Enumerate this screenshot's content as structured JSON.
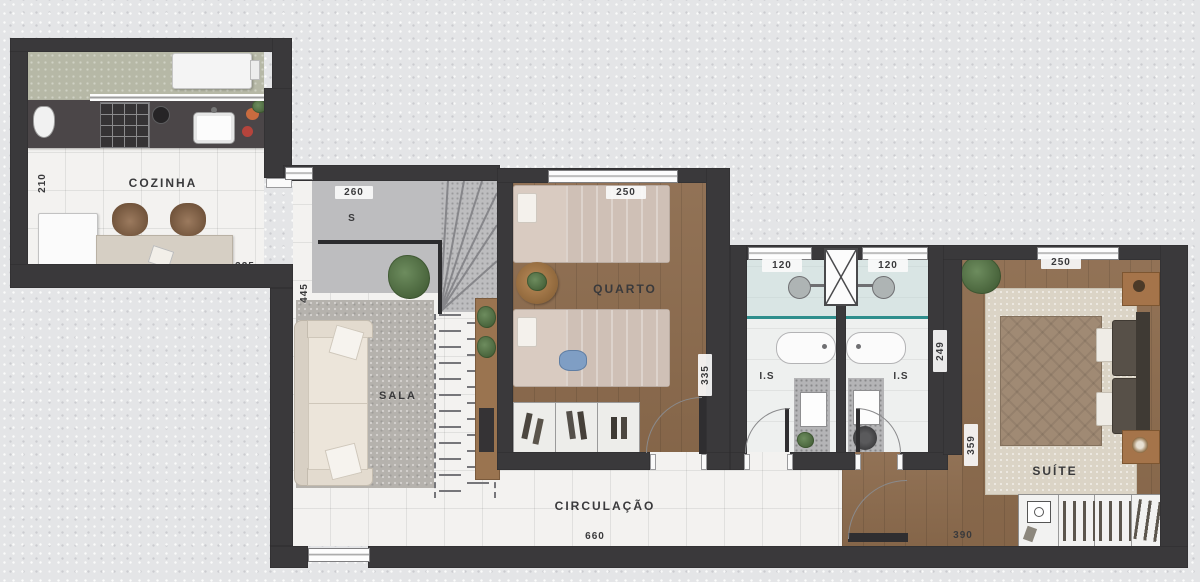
{
  "plan": {
    "rooms": {
      "kitchen": "COZINHA",
      "living": "SALA",
      "bedroom": "QUARTO",
      "bath_left": "I.S",
      "bath_right": "I.S",
      "suite": "SUÍTE",
      "hall": "CIRCULAÇÃO"
    },
    "dims": {
      "kitchen_depth": "210",
      "kitchen_width": "325",
      "stair_width": "260",
      "stair_direction": "S",
      "living_depth": "445",
      "bedroom_width": "250",
      "bedroom_depth": "335",
      "bath_left_width": "120",
      "bath_right_width": "120",
      "bath_depth": "249",
      "suite_width": "250",
      "suite_depth": "359",
      "suite_length": "390",
      "hall_length": "660"
    },
    "colors": {
      "wall": "#3a393b",
      "wood_floor": "#8c6b4d",
      "tile_floor": "#f3f2f0",
      "balcony_floor": "#b6b8a6",
      "stair_floor": "#bdbdbf",
      "glass_accent": "#2e8e8c",
      "background": "#e4e5e7"
    },
    "furniture_icons": [
      "washer-icon",
      "stove-icon",
      "kitchen-sink-icon",
      "water-jug-icon",
      "pan-icon",
      "fridge-icon",
      "dining-table",
      "stool-icon",
      "sofa",
      "living-rug",
      "console-table",
      "plant-icon",
      "staircase",
      "stair-handrail",
      "void-projection",
      "single-bed",
      "round-side-table",
      "shoe-wardrobe",
      "duct-shaft-icon",
      "shower-icon",
      "glass-partition",
      "bathtub-icon",
      "vanity-sink-icon",
      "toilet-icon",
      "double-bed",
      "nightstand",
      "suite-rug",
      "wardrobe",
      "safe-icon",
      "door-leaf"
    ]
  }
}
